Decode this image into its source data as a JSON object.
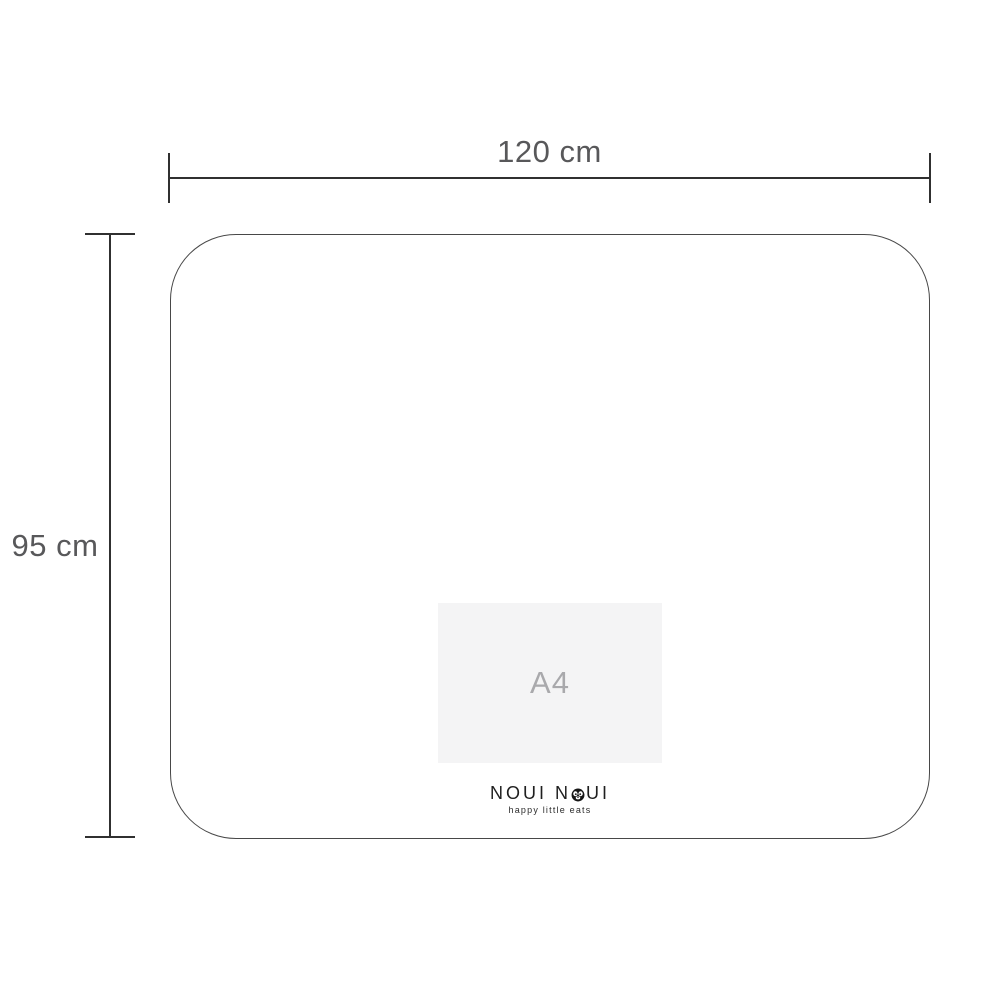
{
  "diagram": {
    "width_label": "120 cm",
    "height_label": "95 cm",
    "reference_label": "A4"
  },
  "logo": {
    "name_prefix": "NOUI N",
    "name_suffix": "UI",
    "full_name": "NOUI NOUI",
    "tagline": "happy little eats"
  },
  "colors": {
    "background": "#ffffff",
    "line": "#303030",
    "mat_outline": "#484848",
    "dimension_text": "#58585a",
    "a4_fill": "#f4f4f5",
    "a4_text": "#a9a9ac",
    "logo_text": "#1f1f1f"
  }
}
